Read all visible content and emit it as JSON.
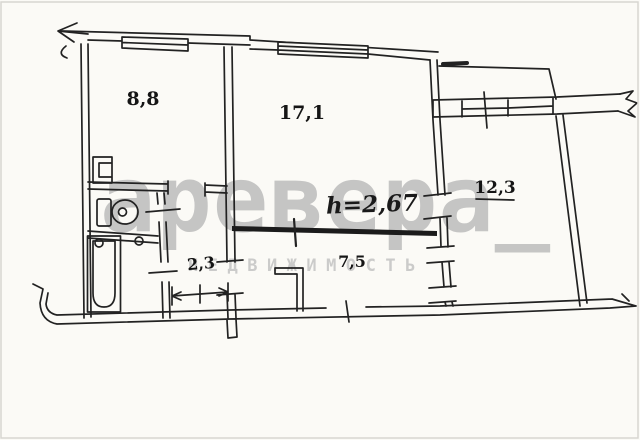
{
  "canvas": {
    "width": 640,
    "height": 440,
    "background": "#fbfaf6",
    "line_color": "#222222",
    "thick_wall_color": "#1b1b1b",
    "border_color": "#d8d6d1",
    "watermark_color": "#bcbcbc"
  },
  "plan": {
    "type": "apartment_floor_plan",
    "rooms": [
      {
        "id": "room-1",
        "label": "8,8"
      },
      {
        "id": "room-2",
        "label": "17,1"
      },
      {
        "id": "room-3",
        "label": "12,3"
      },
      {
        "id": "corridor",
        "label": "2,3"
      },
      {
        "id": "hall",
        "label": "7,5"
      }
    ],
    "ceiling_height_label": "h=2,67"
  },
  "watermark": {
    "main": "аревера_",
    "sub": "НЕДВИЖИМОСТЬ"
  }
}
